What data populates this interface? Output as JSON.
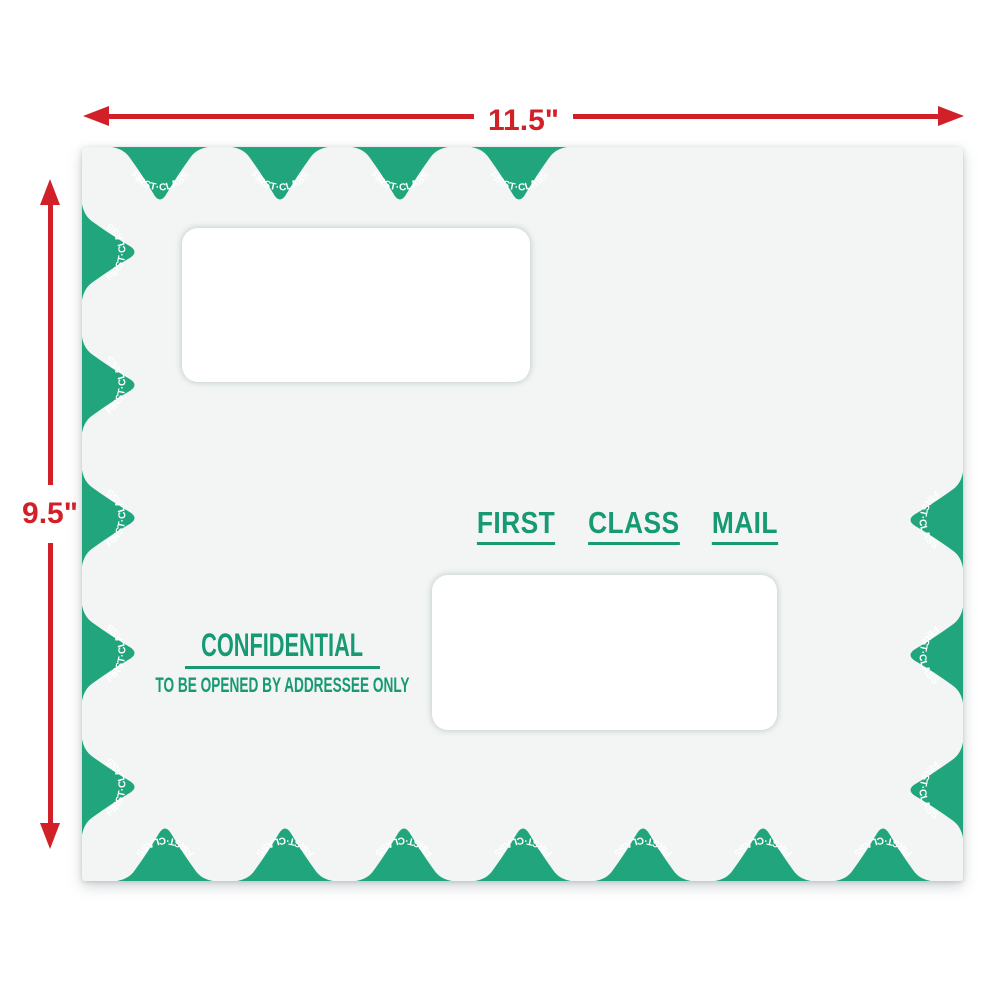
{
  "dimensions": {
    "width_label": "11.5\"",
    "height_label": "9.5\""
  },
  "envelope": {
    "border_stamp_label": "FIRST·CLASS",
    "border_stamp_counts": {
      "top": 4,
      "left": 5,
      "right": 3,
      "bottom": 7
    },
    "center_stamp_words": [
      "FIRST",
      "CLASS",
      "MAIL"
    ],
    "confidential_title": "CONFIDENTIAL",
    "confidential_subtitle": "TO BE OPENED BY ADDRESSEE ONLY",
    "window_count": 2
  },
  "colors": {
    "stamp_green": "#21a57c",
    "text_green": "#179a73",
    "dimension_red": "#d22028",
    "envelope_bg": "#f2f5f4",
    "window_white": "#ffffff"
  }
}
